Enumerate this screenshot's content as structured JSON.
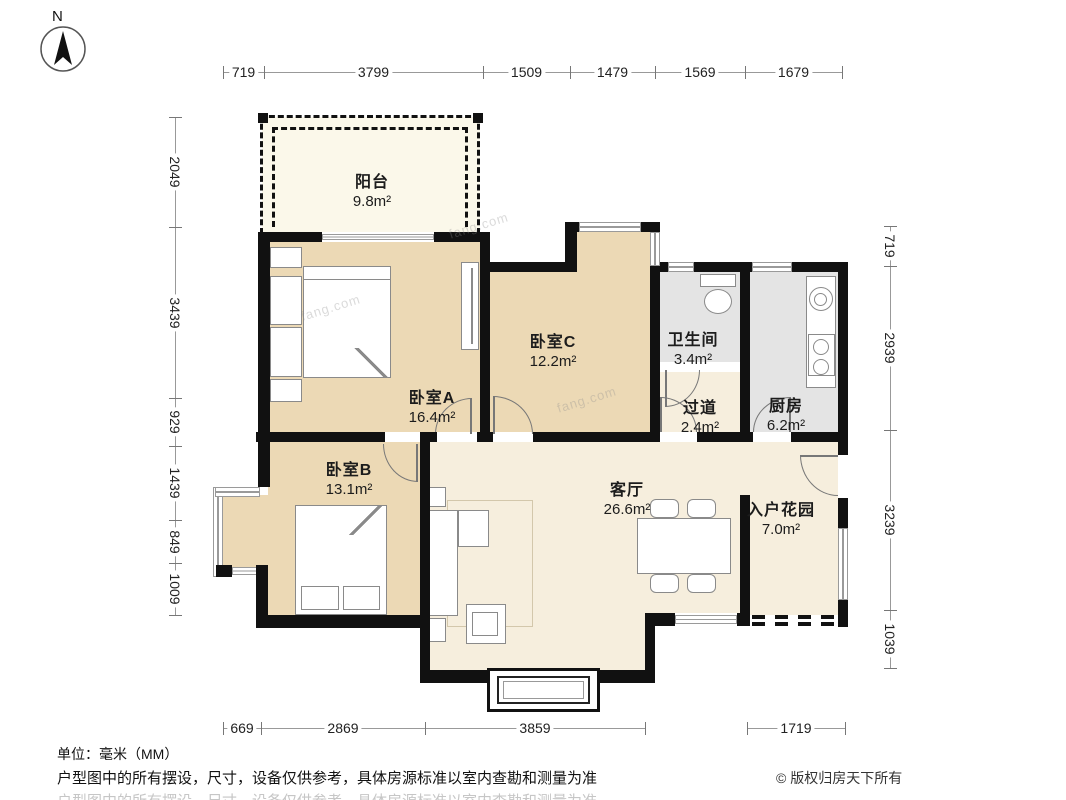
{
  "compass": {
    "label": "N"
  },
  "rooms": [
    {
      "id": "balcony",
      "name": "阳台",
      "area": "9.8m²"
    },
    {
      "id": "bedroomA",
      "name": "卧室A",
      "area": "16.4m²"
    },
    {
      "id": "bedroomC",
      "name": "卧室C",
      "area": "12.2m²"
    },
    {
      "id": "bathroom",
      "name": "卫生间",
      "area": "3.4m²"
    },
    {
      "id": "hallway",
      "name": "过道",
      "area": "2.4m²"
    },
    {
      "id": "kitchen",
      "name": "厨房",
      "area": "6.2m²"
    },
    {
      "id": "bedroomB",
      "name": "卧室B",
      "area": "13.1m²"
    },
    {
      "id": "living",
      "name": "客厅",
      "area": "26.6m²"
    },
    {
      "id": "garden",
      "name": "入户花园",
      "area": "7.0m²"
    }
  ],
  "dimensions": {
    "top": [
      "719",
      "3799",
      "1509",
      "1479",
      "1569",
      "1679"
    ],
    "left": [
      "2049",
      "3439",
      "929",
      "1439",
      "849",
      "1009"
    ],
    "right": [
      "719",
      "2939",
      "3239",
      "1039"
    ],
    "bottom": [
      "669",
      "2869",
      "3859",
      "1719"
    ]
  },
  "footer": {
    "unit": "单位：毫米（MM）",
    "disclaimer": "户型图中的所有摆设，尺寸，设备仅供参考，具体房源标准以室内查勘和测量为准",
    "copyright": "© 版权归房天下所有"
  },
  "watermark": "fang.com",
  "colors": {
    "wall": "#111111",
    "bedroom": "#ecd9b5",
    "living": "#f6eedd",
    "service": "#e4e4e4",
    "balcony": "#fbf8ea"
  }
}
